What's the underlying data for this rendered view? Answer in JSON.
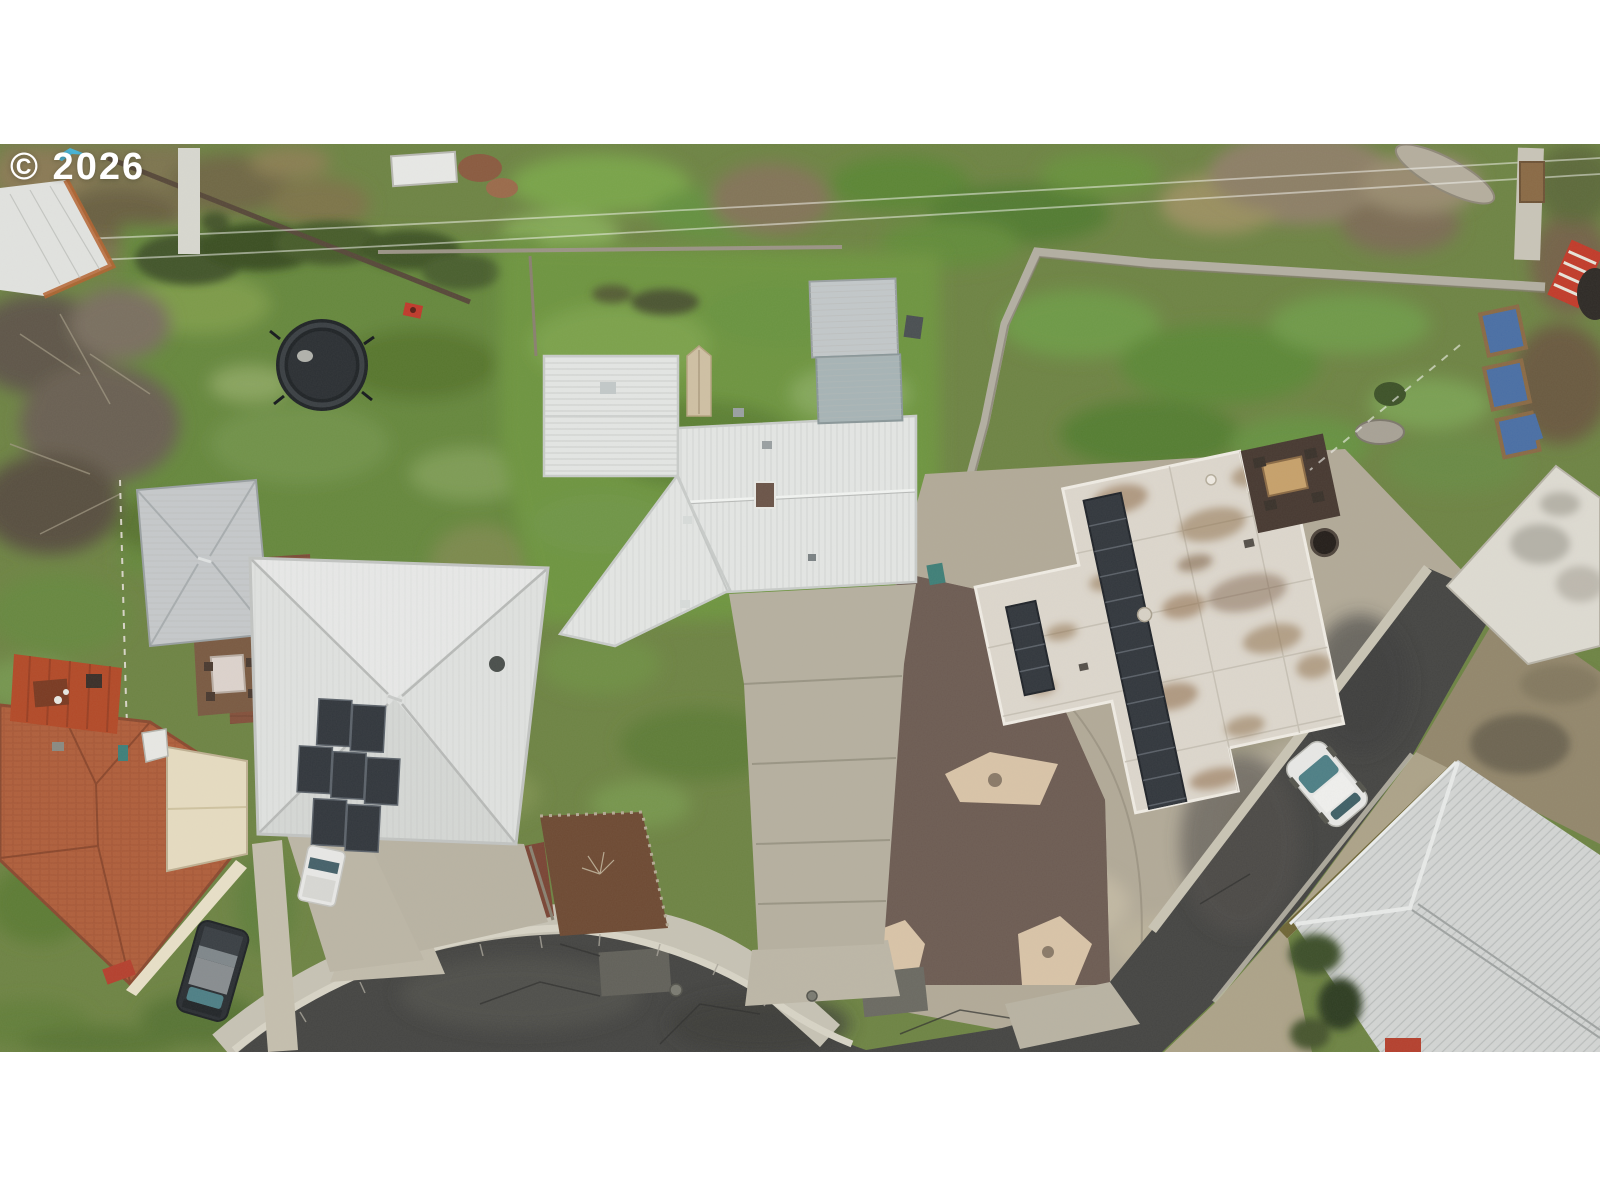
{
  "watermark": {
    "text": "© 2026",
    "color": "#ffffff",
    "mark_color": "#4ab3d4"
  },
  "photo": {
    "kind": "aerial-drone-photo",
    "description": "Overhead aerial drone view of a residential cul-de-sac neighborhood with four homes, green yards, concrete driveways, a gravel xeriscape, rooftop solar panels, a trampoline and parked vehicles",
    "width_px": 1600,
    "height_px": 908,
    "top_offset_px": 144
  },
  "scene": {
    "palette": {
      "grass_base": "#6e8444",
      "grass_bright": "#6f9a3c",
      "grass_dark": "#4f6e2e",
      "asphalt": "#454543",
      "concrete": "#b2aa98",
      "sidewalk": "#c7c3b5",
      "curb": "#d8d4c6",
      "metal_roof_white": "#e4e6e4",
      "hip_roof_white": "#e0e2e0",
      "flat_roof_white": "#ddd7cd",
      "shingle_roof_gray": "#d3d5d4",
      "shed_roof_gray": "#c6c9cb",
      "carport_gray": "#a7b4b6",
      "terracotta": "#b05f3c",
      "cream_gable": "#e6dcc1",
      "deck_red": "#b34a28",
      "solar_panel": "#32373d",
      "gravel": "#6d5c54",
      "stone_patch": "#d9c4a8",
      "trampoline": "#1f2326",
      "suv_dark": "#2b2f33",
      "car_white": "#e8e8e6",
      "glass_teal": "#4e7f86",
      "roof_stain": "#8a6743",
      "timber_wall": "#6f6636",
      "tarp_blue": "#4a6fa5",
      "mulch": "#6e4a33"
    },
    "objects": [
      {
        "name": "trampoline"
      },
      {
        "name": "house-left-hip-roof",
        "solar_panels": true
      },
      {
        "name": "house-center-metal-roof"
      },
      {
        "name": "house-right-flat-roof",
        "solar_panels": true
      },
      {
        "name": "house-bottom-right-shingle-roof"
      },
      {
        "name": "house-terracotta-roof"
      },
      {
        "name": "gray-shed"
      },
      {
        "name": "carport-shed"
      },
      {
        "name": "far-right-building"
      },
      {
        "name": "dark-suv"
      },
      {
        "name": "white-car"
      },
      {
        "name": "white-truck"
      },
      {
        "name": "cul-de-sac-road"
      },
      {
        "name": "gravel-xeriscape"
      },
      {
        "name": "patio-table"
      },
      {
        "name": "garden-beds-blue-tarps"
      },
      {
        "name": "red-lawn-mower"
      }
    ]
  }
}
